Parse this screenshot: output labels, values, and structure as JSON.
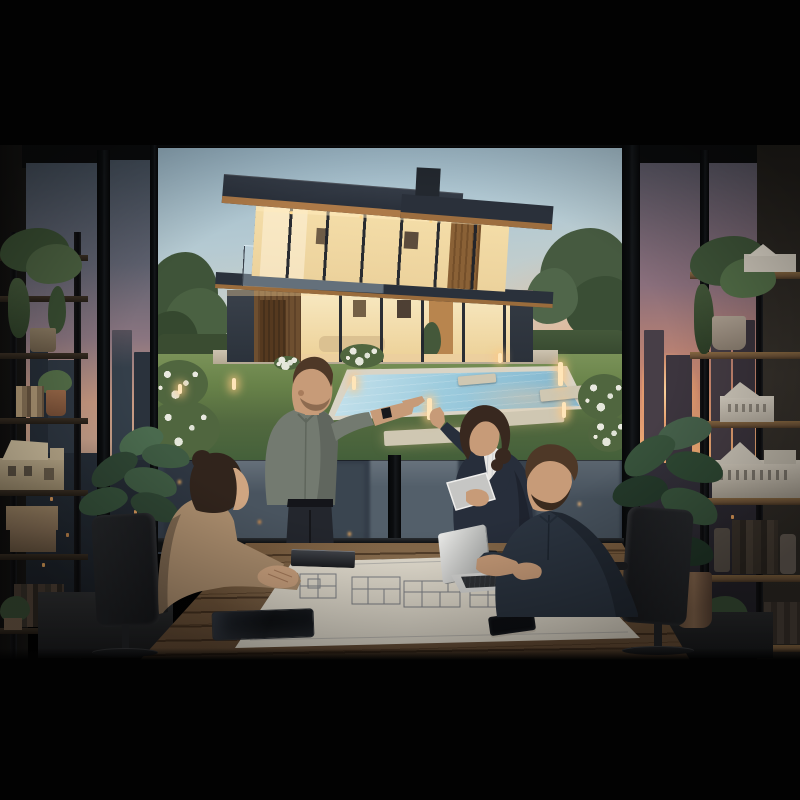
{
  "palette": {
    "black": "#020202",
    "wall_left": "#171614",
    "wall_right": "#37322c",
    "frame": "#0b0d0f",
    "dusk_top": "#47525f",
    "dusk_mid": "#8a7580",
    "dusk_pink": "#c99a82",
    "dusk_horizon": "#8a7668",
    "sunset_top": "#5d5a68",
    "sunset_orange": "#f2ac74",
    "sunset_deep": "#d08a6e",
    "city_base": "#343d49",
    "city_dark": "#2e3641",
    "city_light": "#535f6a",
    "window_lit": "#e8a85e",
    "poster_sky_top": "#9cb9ca",
    "poster_sky_mid": "#c9cfc9",
    "poster_sky_warm": "#e0c0a4",
    "poster_pink": "#eab094",
    "house_charcoal": "#2c333d",
    "house_charcoal_dark": "#272d37",
    "soffit_wood": "#ad7a48",
    "siding_wood": "#6e4f30",
    "glass_glow": "#f4dda8",
    "glass_glow_deep": "#ecd096",
    "interior_wood": "#b8854e",
    "lawn_light": "#7a9258",
    "lawn_dark": "#44603a",
    "hedge": "#3c5136",
    "tree_green": "#465a40",
    "tree_dark": "#35482f",
    "stone": "#cfc7b2",
    "coping": "#d9d4c6",
    "pool_light": "#c6e2ec",
    "pool_deep": "#7fb3cc",
    "bollard": "#ffe5b8",
    "bush_green": "#50663f",
    "bush_white": "#e9e9e0",
    "shelf_board": "#241d16",
    "shelf_wood": "#6e5338",
    "post": "#0a0a0c",
    "model_wood": "#bfae8e",
    "model_white": "#d6cfc2",
    "book_tan": "#b39b78",
    "book_dark": "#3c342c",
    "box_tan": "#a08868",
    "plant_green": "#3e5a42",
    "plant_dark": "#2f4634",
    "pot_terracotta": "#8a6a50",
    "pot_gray": "#9c8d7e",
    "floor_light": "#333436",
    "floor_dark": "#191a1c",
    "chair_dark": "#202225",
    "table_light": "#97764e",
    "table_mid": "#8a6a46",
    "table_dark": "#4a3627",
    "paper": "#e3ddcf",
    "paper_shadow": "#cfc7b8",
    "plan_line": "#6f737c",
    "laptop_silver": "#d9d9d7",
    "device_black": "#101215",
    "skin": "#c79b78",
    "skin_light": "#cfa581",
    "skin_shadow": "#a87c5c",
    "hair_dark": "#31241c",
    "hair_brown": "#4e3827",
    "hair_woman": "#38281f",
    "shirt_sage": "#737a70",
    "shirt_sage_dark": "#5f665c",
    "blazer": "#272e3b",
    "blazer_dark": "#1d2330",
    "sweater": "#2b3440",
    "blouse": "#ad8f6f",
    "shirt_white": "#e9e7e3",
    "pants_dark": "#23262d",
    "belt": "#14151a",
    "tablet_silver": "#c6c6c4",
    "watch": "#17181c"
  },
  "objects": {
    "room": {
      "label": "Dusk architecture office with floor-to-ceiling city windows"
    },
    "poster": {
      "label": "Rendering of a modern two-story house with glowing windows, lawn and pool at dusk"
    },
    "left_window": {
      "label": "Left window, dusk sky and city skyline"
    },
    "right_window": {
      "label": "Right window, orange sunset and city skyline"
    },
    "center_window": {
      "label": "Window behind table with blurred city buildings"
    },
    "left_shelf": {
      "label": "Black shelf with trailing plants, books, boxes and a wooden house model"
    },
    "right_shelf": {
      "label": "Black shelf with white architectural house models, books and plants"
    },
    "table": {
      "label": "Rustic wooden meeting table"
    },
    "blueprint": {
      "label": "Large floor-plan blueprint sheet"
    },
    "laptop_open": {
      "label": "Open silver laptop"
    },
    "laptop_closed": {
      "label": "Closed black laptop"
    },
    "tablet_black": {
      "label": "Black tablet lying on table"
    },
    "notebook": {
      "label": "Dark notebook"
    },
    "phone": {
      "label": "Smartphone"
    },
    "chair_left": {
      "label": "Black mesh office chair, left"
    },
    "chair_right": {
      "label": "Black mesh office chair, right"
    },
    "plant_left": {
      "label": "Potted plant beside left window"
    },
    "plant_right": {
      "label": "Tall potted plant beside right window"
    },
    "people": {
      "seated_woman": {
        "label": "Seated woman in tan blouse with clasped hands"
      },
      "standing_man": {
        "label": "Standing man in sage shirt pointing at the house rendering"
      },
      "standing_woman": {
        "label": "Standing woman in navy blazer holding a tablet"
      },
      "seated_man": {
        "label": "Seated bearded man typing on laptop"
      }
    }
  }
}
